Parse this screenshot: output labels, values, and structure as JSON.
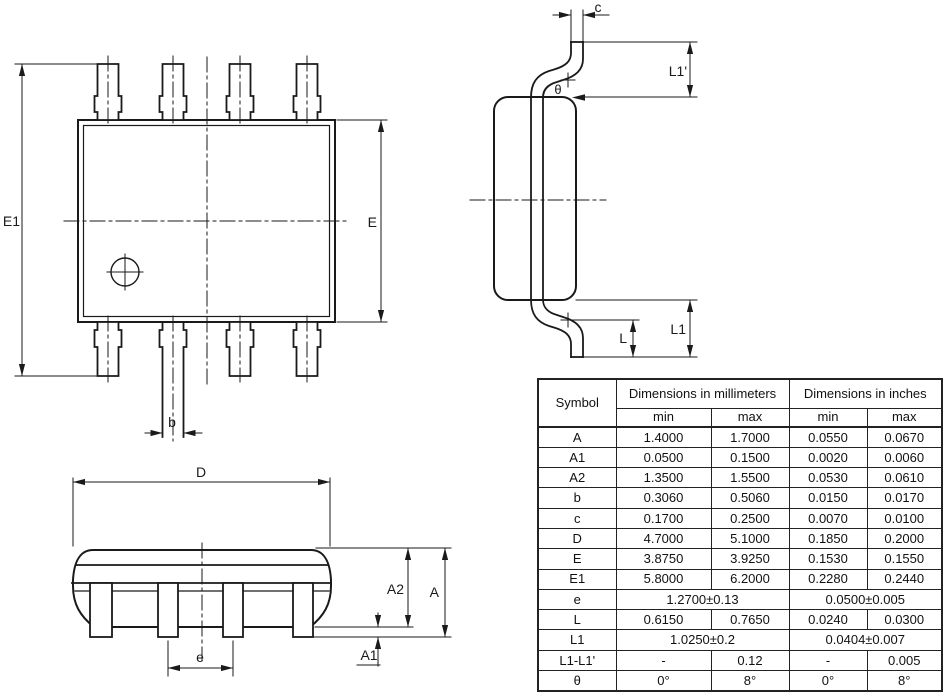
{
  "drawing": {
    "top_view": {
      "labels": {
        "e1": "E1",
        "e": "E",
        "b": "b"
      }
    },
    "side_view": {
      "labels": {
        "c": "c",
        "l1_prime": "L1'",
        "theta": "θ",
        "l": "L",
        "l1": "L1"
      }
    },
    "front_view": {
      "labels": {
        "d": "D",
        "a2": "A2",
        "a": "A",
        "a1": "A1",
        "e": "e"
      }
    }
  },
  "table": {
    "header": {
      "symbol": "Symbol",
      "mm": "Dimensions in millimeters",
      "inch": "Dimensions in inches",
      "min": "min",
      "max": "max"
    },
    "rows": [
      {
        "symbol": "A",
        "mm": [
          "1.4000",
          "1.7000"
        ],
        "inch": [
          "0.0550",
          "0.0670"
        ]
      },
      {
        "symbol": "A1",
        "mm": [
          "0.0500",
          "0.1500"
        ],
        "inch": [
          "0.0020",
          "0.0060"
        ]
      },
      {
        "symbol": "A2",
        "mm": [
          "1.3500",
          "1.5500"
        ],
        "inch": [
          "0.0530",
          "0.0610"
        ]
      },
      {
        "symbol": "b",
        "mm": [
          "0.3060",
          "0.5060"
        ],
        "inch": [
          "0.0150",
          "0.0170"
        ]
      },
      {
        "symbol": "c",
        "mm": [
          "0.1700",
          "0.2500"
        ],
        "inch": [
          "0.0070",
          "0.0100"
        ]
      },
      {
        "symbol": "D",
        "mm": [
          "4.7000",
          "5.1000"
        ],
        "inch": [
          "0.1850",
          "0.2000"
        ]
      },
      {
        "symbol": "E",
        "mm": [
          "3.8750",
          "3.9250"
        ],
        "inch": [
          "0.1530",
          "0.1550"
        ]
      },
      {
        "symbol": "E1",
        "mm": [
          "5.8000",
          "6.2000"
        ],
        "inch": [
          "0.2280",
          "0.2440"
        ]
      },
      {
        "symbol": "e",
        "mm": [
          "1.2700±0.13"
        ],
        "inch": [
          "0.0500±0.005"
        ]
      },
      {
        "symbol": "L",
        "mm": [
          "0.6150",
          "0.7650"
        ],
        "inch": [
          "0.0240",
          "0.0300"
        ]
      },
      {
        "symbol": "L1",
        "mm": [
          "1.0250±0.2"
        ],
        "inch": [
          "0.0404±0.007"
        ]
      },
      {
        "symbol": "L1-L1'",
        "mm": [
          "-",
          "0.12"
        ],
        "inch": [
          "-",
          "0.005"
        ]
      },
      {
        "symbol": "θ",
        "mm": [
          "0°",
          "8°"
        ],
        "inch": [
          "0°",
          "8°"
        ]
      }
    ]
  }
}
